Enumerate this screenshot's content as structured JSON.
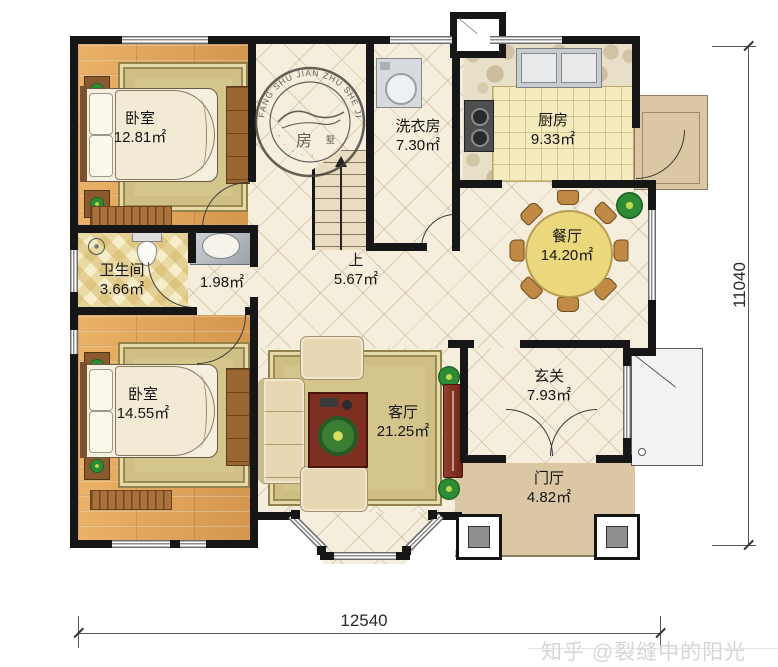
{
  "rooms": {
    "bedroom_top": {
      "name": "卧室",
      "area": "12.81㎡"
    },
    "laundry": {
      "name": "洗衣房",
      "area": "7.30㎡"
    },
    "kitchen": {
      "name": "厨房",
      "area": "9.33㎡"
    },
    "bathroom": {
      "name": "卫生间",
      "area": "3.66㎡"
    },
    "corridor": {
      "area": "1.98㎡"
    },
    "stairs": {
      "name": "上",
      "area": "5.67㎡"
    },
    "dining": {
      "name": "餐厅",
      "area": "14.20㎡"
    },
    "bedroom_bottom": {
      "name": "卧室",
      "area": "14.55㎡"
    },
    "living": {
      "name": "客厅",
      "area": "21.25㎡"
    },
    "entry": {
      "name": "玄关",
      "area": "7.93㎡"
    },
    "foyer": {
      "name": "门厅",
      "area": "4.82㎡"
    }
  },
  "dimensions": {
    "bottom": "12540",
    "right": "11040"
  },
  "watermark": {
    "text": "知乎 @裂缝中的阳光"
  },
  "stamp": {
    "ring_text": "FANG SHU JIAN ZHU SHE JI",
    "center_char": "房",
    "side_char": "墅",
    "bottom_text": "· · · · ·"
  },
  "colors": {
    "wall": "#161616",
    "wood": "#dfa258",
    "tile": "#f5eedd",
    "bath_tile": "#f6eecb",
    "counter": "#f4ebbe",
    "porch_tan": "#dbc7a3",
    "table_yellow": "#ecd87c",
    "tv_red": "#7e2f22"
  }
}
